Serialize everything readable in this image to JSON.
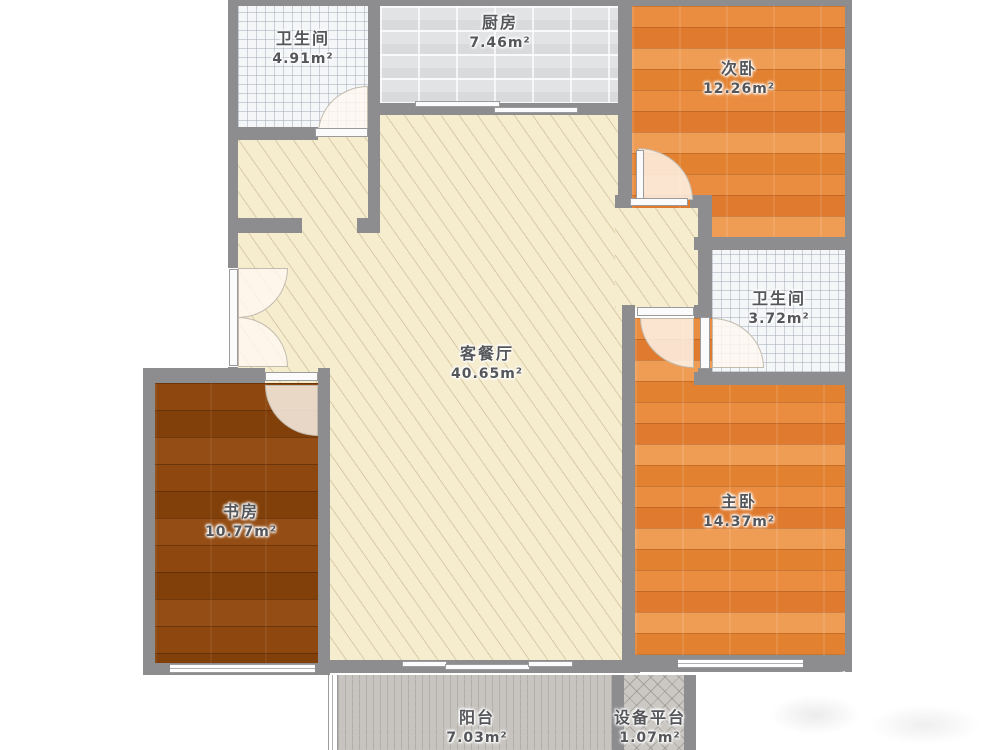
{
  "plan": {
    "rooms": [
      {
        "id": "bathroom-1",
        "name": "卫生间",
        "area": "4.91m²"
      },
      {
        "id": "kitchen",
        "name": "厨房",
        "area": "7.46m²"
      },
      {
        "id": "bedroom-2",
        "name": "次卧",
        "area": "12.26m²"
      },
      {
        "id": "bathroom-2",
        "name": "卫生间",
        "area": "3.72m²"
      },
      {
        "id": "living-dining",
        "name": "客餐厅",
        "area": "40.65m²"
      },
      {
        "id": "study",
        "name": "书房",
        "area": "10.77m²"
      },
      {
        "id": "master-bedroom",
        "name": "主卧",
        "area": "14.37m²"
      },
      {
        "id": "balcony",
        "name": "阳台",
        "area": "7.03m²"
      },
      {
        "id": "equipment-platform",
        "name": "设备平台",
        "area": "1.07m²"
      }
    ],
    "colors": {
      "wall": "#8d8d8f",
      "wood_orange": "#e6853b",
      "wood_dark": "#8a450e",
      "living_cream": "#f6ecce",
      "bath_tile": "#f4f6f8",
      "kitchen_tile": "#e2e3e5",
      "balcony_tile": "#c7c4bf",
      "label_text": "#55565a"
    }
  }
}
